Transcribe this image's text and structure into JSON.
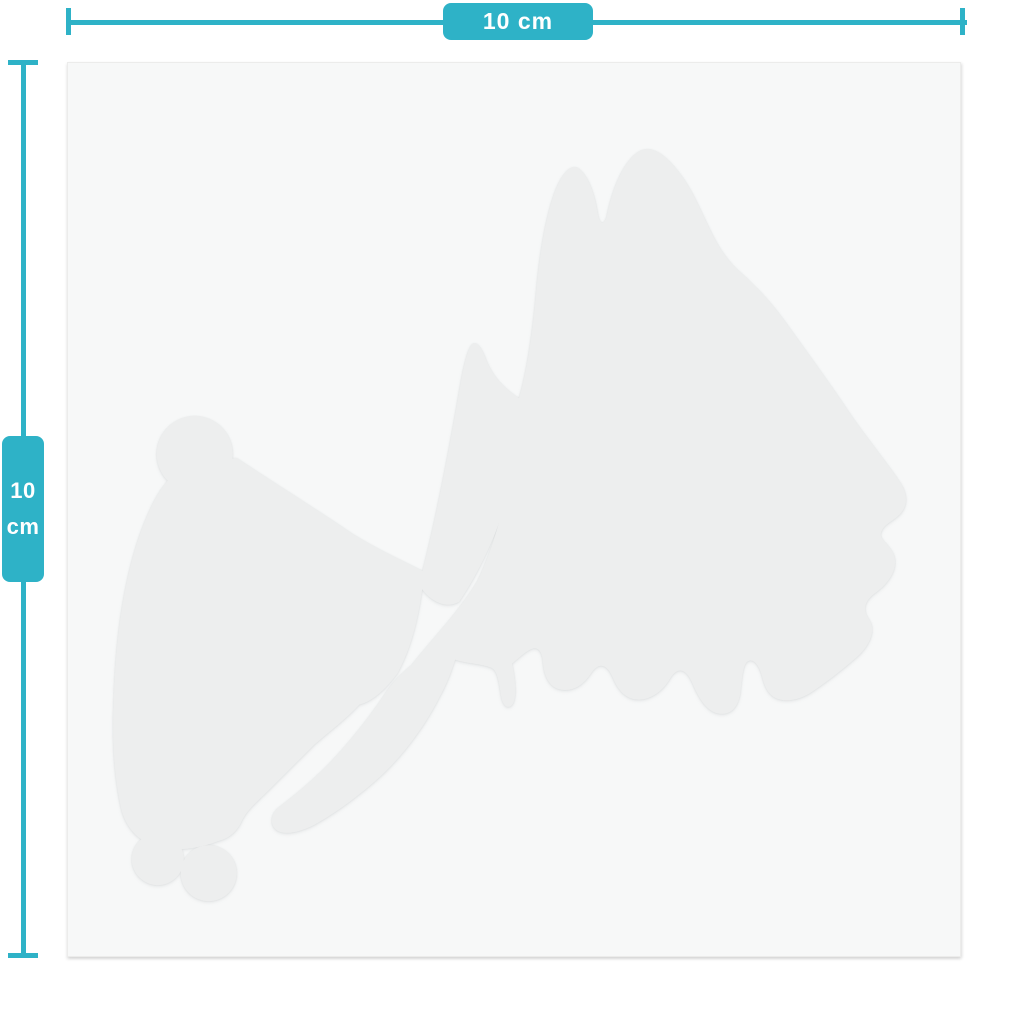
{
  "page": {
    "background": "#ffffff"
  },
  "colors": {
    "page_bg": "#ffffff",
    "accent": "#2eb2c7",
    "on_accent": "#ffffff",
    "sheet_bg": "#f7f8f8",
    "sheet_border": "#ececeb",
    "silhouette_fill": "#edeeee",
    "silhouette_edge": "#8d9496"
  },
  "dimensions": {
    "horizontal": {
      "label": "10 cm"
    },
    "vertical": {
      "value": "10",
      "unit": "cm"
    }
  },
  "sticker": {
    "silhouette": "animal-silhouette"
  }
}
